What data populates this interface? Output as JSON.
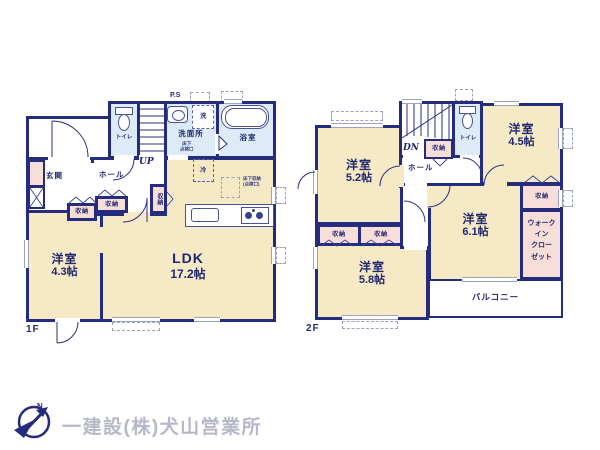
{
  "colors": {
    "wall": "#252b7d",
    "room_tatami": "#f6e9c6",
    "room_wet": "#dcebf7",
    "closet_pink": "#f8ded9"
  },
  "f1": {
    "label": "1F",
    "ps": "P.S",
    "toilet": "トイレ",
    "up": "UP",
    "washroom": "洗面所",
    "washroom_note1": "床下",
    "washroom_note2": "点検口",
    "laundry": "洗",
    "bath": "浴室",
    "entrance": "玄関",
    "hall": "ホール",
    "fridge": "冷",
    "underfloor1": "床下収納",
    "underfloor2": "(点検口)",
    "closet_hall": "収納",
    "closet_mid": "収納",
    "closet_low": "収納",
    "room_name": "洋室",
    "room_size": "4.3帖",
    "ldk_name": "LDK",
    "ldk_size": "17.2帖"
  },
  "f2": {
    "label": "2F",
    "dn": "DN",
    "toilet": "トイレ",
    "hall": "ホール",
    "closet_stairs": "収納",
    "closet_right": "収納",
    "closet_a": "収納",
    "closet_b": "収納",
    "wic1": "ウォーク",
    "wic2": "イン",
    "wic3": "クロー",
    "wic4": "ゼット",
    "r52_name": "洋室",
    "r52_size": "5.2帖",
    "r45_name": "洋室",
    "r45_size": "4.5帖",
    "r61_name": "洋室",
    "r61_size": "6.1帖",
    "r58_name": "洋室",
    "r58_size": "5.8帖",
    "balcony": "バルコニー"
  },
  "footer": {
    "company": "一建設(株)犬山営業所",
    "north": "N"
  }
}
